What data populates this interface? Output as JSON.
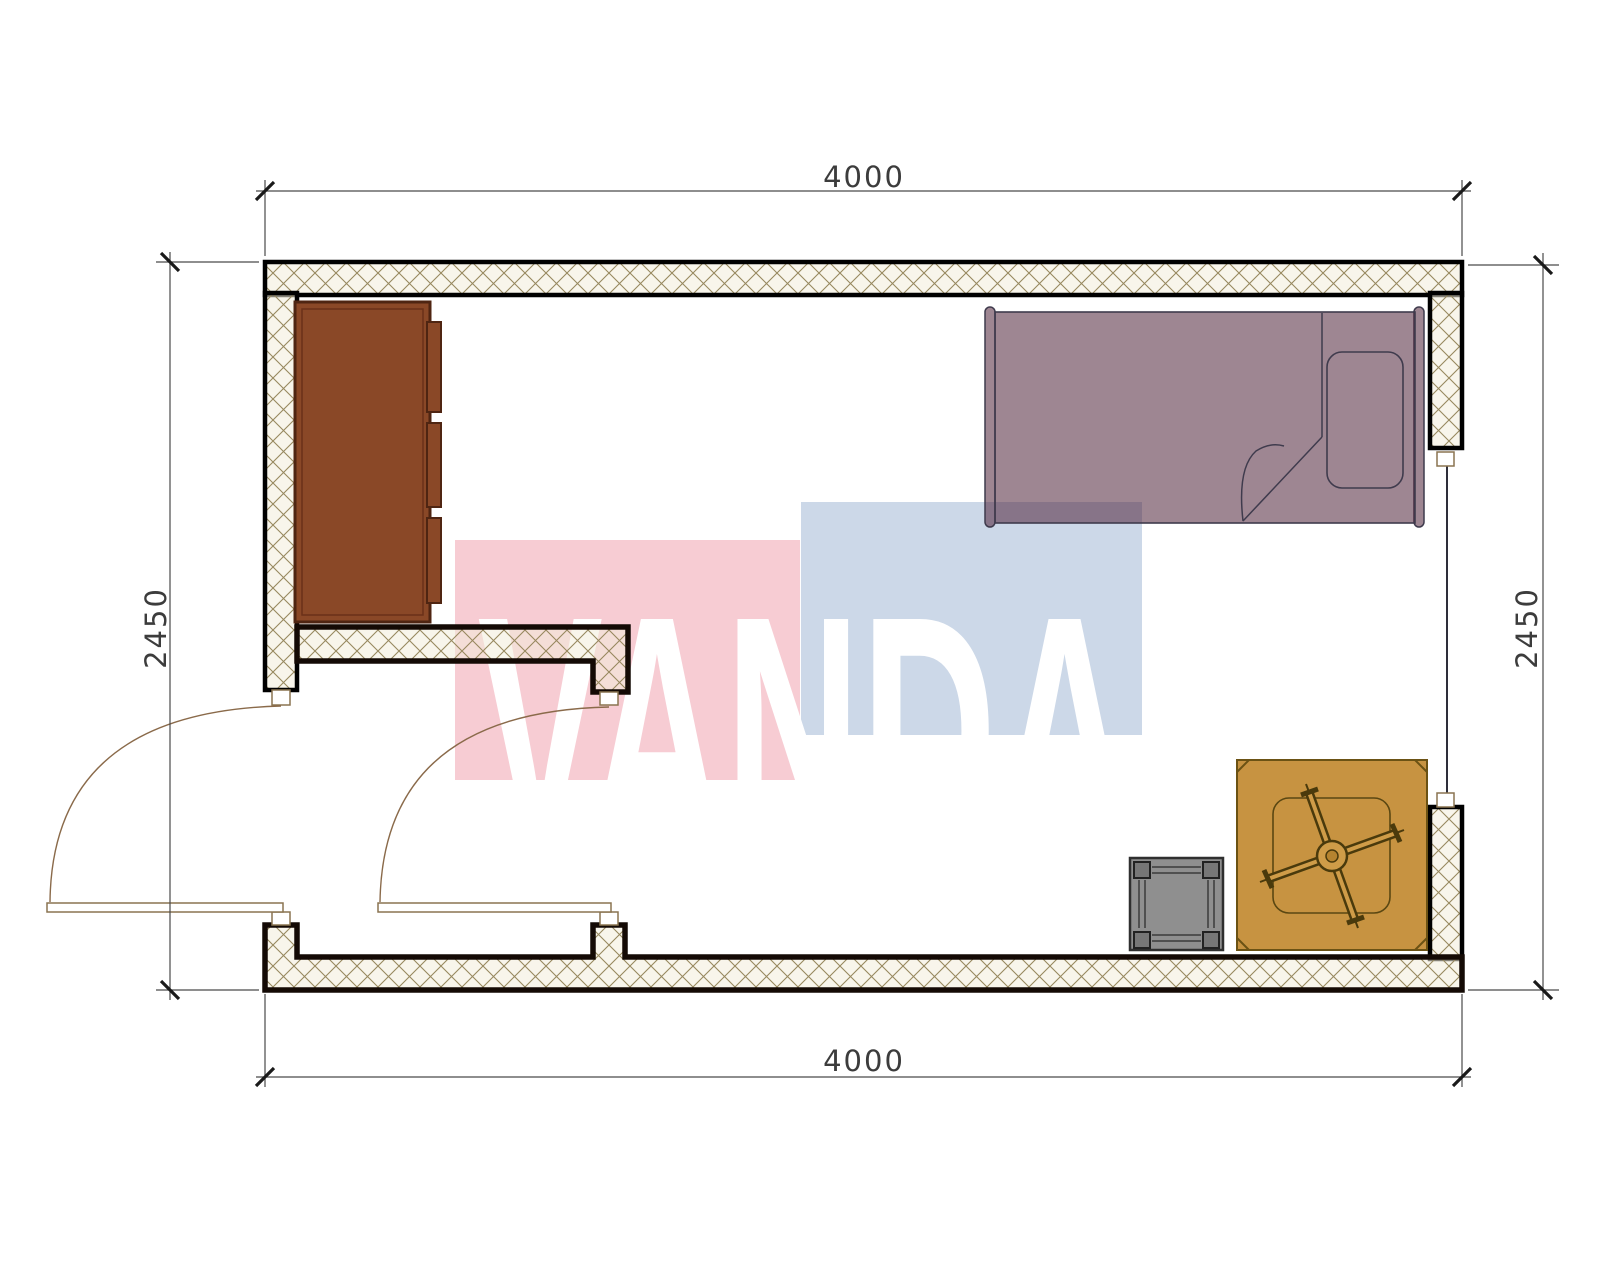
{
  "title": "room-floor-plan",
  "watermark": {
    "text": "VANDA",
    "pink_color": "#f7ccd3",
    "blue_color": "#ccd8e8",
    "text_color": "#ffffff"
  },
  "dimensions": {
    "top": "4000",
    "bottom": "4000",
    "left": "2450",
    "right": "2450"
  },
  "room": {
    "width_mm": "4000",
    "depth_mm": "2450"
  },
  "palette": {
    "paper": "#ffffff",
    "wall_hatch_line": "#97885e",
    "wall_hatch_bg": "rgba(243,236,218,0.55)",
    "outer_wall_outline": "#000000",
    "partition_outline": "#140a05",
    "wardrobe_fill": "#8a4827",
    "wardrobe_outline": "#4f2512",
    "bed_fill": "#9e8692",
    "bed_outline": "#3f3b4d",
    "chair_mat_fill": "#c79341",
    "chair_outline": "#4a3a0c",
    "stool_fill": "#8f8f8f",
    "door_line": "#8a7450",
    "dimension_line": "#4a4a4a",
    "dimension_text": "#3c3c3c"
  },
  "furniture": [
    {
      "name": "wardrobe"
    },
    {
      "name": "bed"
    },
    {
      "name": "desk-chair"
    },
    {
      "name": "stool"
    }
  ]
}
